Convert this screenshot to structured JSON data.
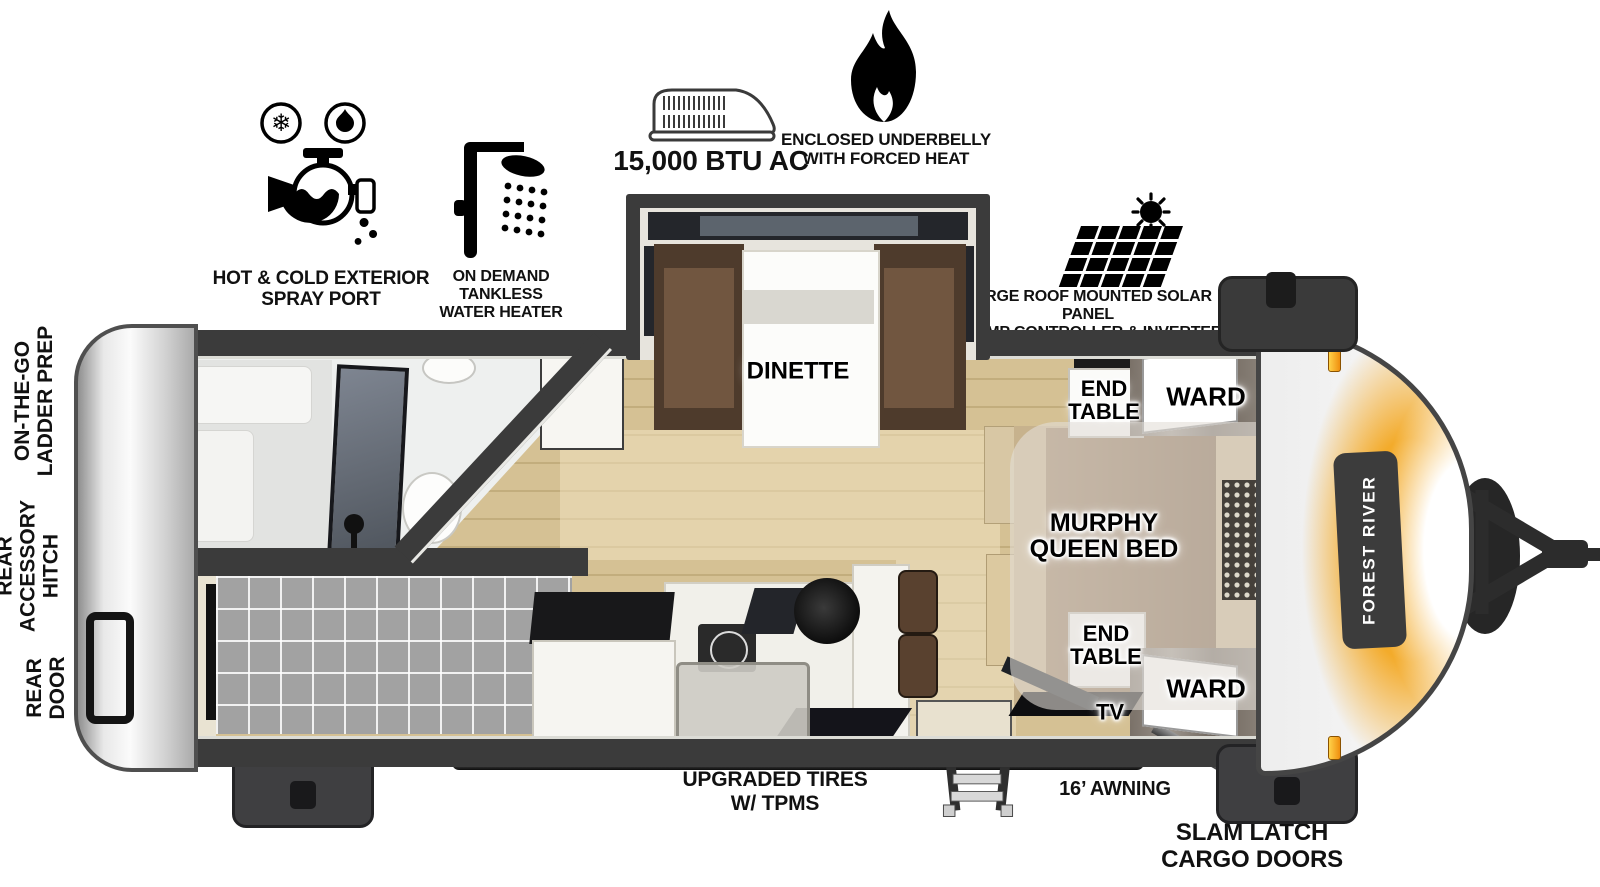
{
  "features": [
    {
      "icon": "hot-cold-spray-port-icon",
      "label": "HOT & COLD EXTERIOR\nSPRAY PORT"
    },
    {
      "icon": "tankless-water-heater-icon",
      "label": "ON DEMAND\nTANKLESS\nWATER HEATER"
    },
    {
      "icon": "ac-unit-icon",
      "label": "15,000 BTU AC"
    },
    {
      "icon": "forced-heat-flame-icon",
      "label": "ENCLOSED UNDERBELLY\nWITH FORCED HEAT"
    },
    {
      "icon": "solar-panel-icon",
      "label": "LARGE ROOF MOUNTED SOLAR PANEL\n30 AMP CONTROLLER & INVERTER PREP"
    }
  ],
  "rooms": {
    "shower": "SHOWER",
    "pantry": "PANTRY",
    "dinette": "DINETTE",
    "end_table_top": "END\nTABLE",
    "ward_top": "WARD",
    "murphy_bed": "MURPHY\nQUEEN BED",
    "end_table_bottom": "END\nTABLE",
    "ward_bottom": "WARD",
    "tv": "TV",
    "bar_top": "BAR TOP",
    "air_fryer_micro": "AIR FRYER/\nMICRO",
    "refer": "REFER",
    "ohc": "OHC",
    "double_bunks": "44” X 74\nDOUBLE BUNKS"
  },
  "exterior": {
    "ladder_prep": "ON-THE-GO\nLADDER PREP",
    "rear_accessory_hitch": "REAR\nACCESSORY\nHITCH",
    "rear_door": "REAR\nDOOR",
    "upgraded_tires": "UPGRADED TIRES\nW/ TPMS",
    "awning": "16’ AWNING",
    "slam_latch_cargo_doors": "SLAM LATCH\nCARGO DOORS",
    "brand": "FOREST RIVER"
  },
  "colors": {
    "wall": "#3b3b3b",
    "floor_wood": "#d5c194",
    "accent_orange": "#f3a720",
    "bunk_gray": "#a2a2a2",
    "bench_brown": "#4e3b2c"
  }
}
